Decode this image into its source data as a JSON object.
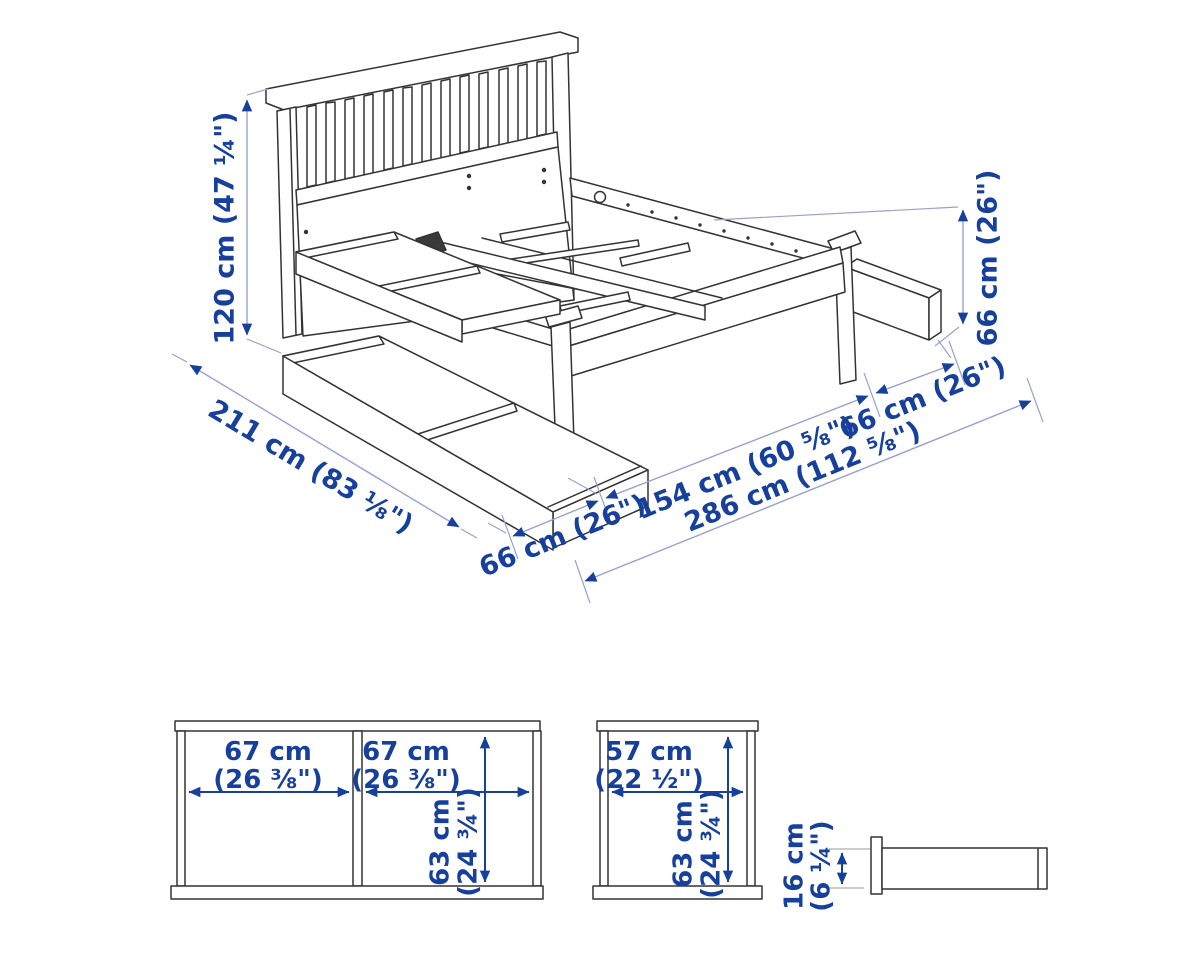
{
  "title": "Bed frame with storage boxes — dimensions diagram",
  "colors": {
    "background": "#ffffff",
    "drawing_line": "#333333",
    "dimension_line": "#99a2cc",
    "accent_blue": "#16409c"
  },
  "main_view": {
    "labels": {
      "height": "120 cm (47 ¼\")",
      "box_height_right": "66 cm (26\")",
      "length": "211 cm (83 ⅛\")",
      "box_left": "66 cm (26\")",
      "width": "154 cm (60 ⅝\")",
      "box_right": "66 cm (26\")",
      "total_width": "286 cm (112 ⅝\")"
    }
  },
  "detail_views": {
    "large_box_front": {
      "width_a": "67 cm",
      "width_a_in": "(26 ⅜\")",
      "width_b": "67 cm",
      "width_b_in": "(26 ⅜\")",
      "depth": "63 cm",
      "depth_in": "(24 ¾\")"
    },
    "small_box_front": {
      "width": "57 cm",
      "width_in": "(22 ½\")",
      "depth": "63 cm",
      "depth_in": "(24 ¾\")"
    },
    "box_side": {
      "height": "16 cm",
      "height_in": "(6 ¼\")"
    }
  }
}
